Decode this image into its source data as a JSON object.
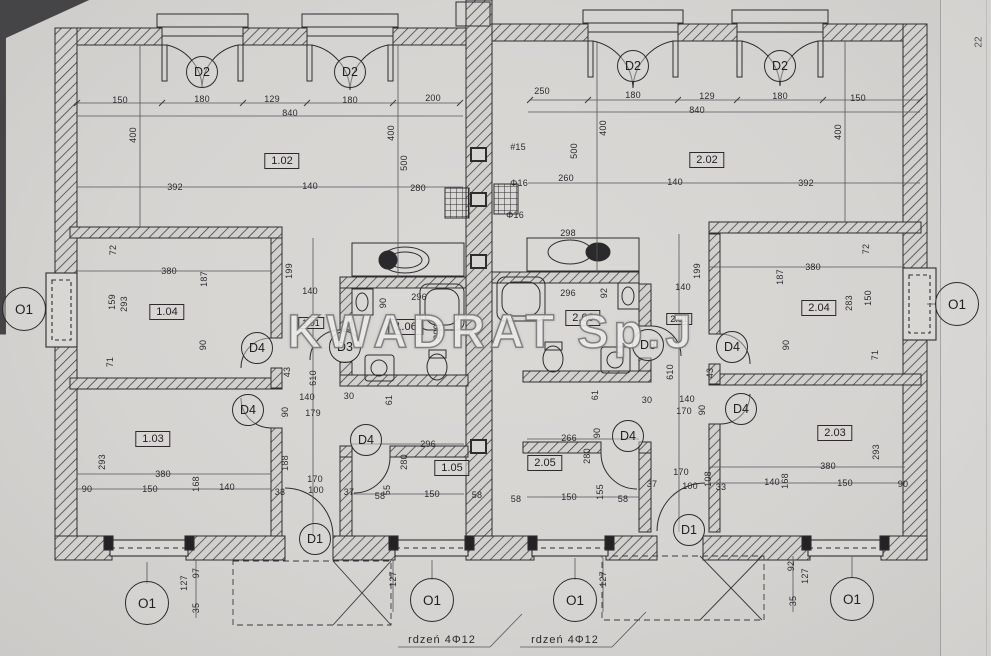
{
  "watermark": "KWADRAT Sp.J",
  "side_note": "22",
  "room_labels": [
    {
      "id": "1.02",
      "x": 282,
      "y": 161
    },
    {
      "id": "2.02",
      "x": 707,
      "y": 160
    },
    {
      "id": "1.04",
      "x": 167,
      "y": 312
    },
    {
      "id": "2.04",
      "x": 819,
      "y": 308
    },
    {
      "id": "1.06",
      "x": 406,
      "y": 327
    },
    {
      "id": "2.06",
      "x": 583,
      "y": 318
    },
    {
      "id": "1.03",
      "x": 153,
      "y": 439
    },
    {
      "id": "2.03",
      "x": 835,
      "y": 433
    },
    {
      "id": "1.05",
      "x": 452,
      "y": 468
    },
    {
      "id": "2.05",
      "x": 545,
      "y": 463
    }
  ],
  "hall_labels": [
    {
      "id": "1.01",
      "x": 311,
      "y": 323
    },
    {
      "id": "2.01",
      "x": 679,
      "y": 319
    }
  ],
  "door_tags": [
    {
      "id": "D2",
      "x": 202,
      "y": 72
    },
    {
      "id": "D2",
      "x": 350,
      "y": 72
    },
    {
      "id": "D2",
      "x": 633,
      "y": 66
    },
    {
      "id": "D2",
      "x": 780,
      "y": 66
    },
    {
      "id": "D4",
      "x": 257,
      "y": 348
    },
    {
      "id": "D4",
      "x": 248,
      "y": 410
    },
    {
      "id": "D4",
      "x": 366,
      "y": 440
    },
    {
      "id": "D4",
      "x": 628,
      "y": 436
    },
    {
      "id": "D4",
      "x": 732,
      "y": 347
    },
    {
      "id": "D4",
      "x": 741,
      "y": 409
    },
    {
      "id": "D3",
      "x": 345,
      "y": 347
    },
    {
      "id": "D3",
      "x": 648,
      "y": 345
    },
    {
      "id": "D1",
      "x": 315,
      "y": 539
    },
    {
      "id": "D1",
      "x": 689,
      "y": 530
    }
  ],
  "window_tags": [
    {
      "id": "O1",
      "x": 24,
      "y": 309
    },
    {
      "id": "O1",
      "x": 957,
      "y": 304
    },
    {
      "id": "O1",
      "x": 147,
      "y": 603
    },
    {
      "id": "O1",
      "x": 432,
      "y": 600
    },
    {
      "id": "O1",
      "x": 575,
      "y": 600
    },
    {
      "id": "O1",
      "x": 852,
      "y": 599
    }
  ],
  "notes": [
    {
      "t": "rdzeń 4Φ12",
      "x": 442,
      "y": 640
    },
    {
      "t": "rdzeń 4Φ12",
      "x": 565,
      "y": 640
    }
  ],
  "dims": [
    {
      "t": "150",
      "x": 120,
      "y": 100
    },
    {
      "t": "180",
      "x": 202,
      "y": 99
    },
    {
      "t": "129",
      "x": 272,
      "y": 99
    },
    {
      "t": "180",
      "x": 350,
      "y": 100
    },
    {
      "t": "200",
      "x": 433,
      "y": 98
    },
    {
      "t": "840",
      "x": 290,
      "y": 113
    },
    {
      "t": "250",
      "x": 542,
      "y": 91
    },
    {
      "t": "180",
      "x": 633,
      "y": 95
    },
    {
      "t": "129",
      "x": 707,
      "y": 96
    },
    {
      "t": "180",
      "x": 780,
      "y": 96
    },
    {
      "t": "150",
      "x": 858,
      "y": 98
    },
    {
      "t": "840",
      "x": 697,
      "y": 110
    },
    {
      "t": "400",
      "x": 133,
      "y": 135,
      "r": 1
    },
    {
      "t": "400",
      "x": 391,
      "y": 133,
      "r": 1
    },
    {
      "t": "500",
      "x": 404,
      "y": 163,
      "r": 1
    },
    {
      "t": "500",
      "x": 574,
      "y": 151,
      "r": 1
    },
    {
      "t": "400",
      "x": 603,
      "y": 128,
      "r": 1
    },
    {
      "t": "400",
      "x": 838,
      "y": 132,
      "r": 1
    },
    {
      "t": "392",
      "x": 175,
      "y": 187
    },
    {
      "t": "140",
      "x": 310,
      "y": 186
    },
    {
      "t": "140",
      "x": 675,
      "y": 182
    },
    {
      "t": "392",
      "x": 806,
      "y": 183
    },
    {
      "t": "280",
      "x": 418,
      "y": 188
    },
    {
      "t": "260",
      "x": 566,
      "y": 178
    },
    {
      "t": "298",
      "x": 568,
      "y": 233
    },
    {
      "t": "#15",
      "x": 518,
      "y": 147
    },
    {
      "t": "Φ16",
      "x": 519,
      "y": 183
    },
    {
      "t": "Φ16",
      "x": 515,
      "y": 215
    },
    {
      "t": "296",
      "x": 419,
      "y": 297
    },
    {
      "t": "296",
      "x": 568,
      "y": 293
    },
    {
      "t": "90",
      "x": 383,
      "y": 303,
      "r": 1
    },
    {
      "t": "92",
      "x": 604,
      "y": 293,
      "r": 1
    },
    {
      "t": "200",
      "x": 437,
      "y": 332,
      "r": 1
    },
    {
      "t": "72",
      "x": 113,
      "y": 250,
      "r": 1
    },
    {
      "t": "380",
      "x": 169,
      "y": 271
    },
    {
      "t": "187",
      "x": 204,
      "y": 279,
      "r": 1
    },
    {
      "t": "159",
      "x": 112,
      "y": 302,
      "r": 1
    },
    {
      "t": "293",
      "x": 124,
      "y": 304,
      "r": 1
    },
    {
      "t": "90",
      "x": 203,
      "y": 345,
      "r": 1
    },
    {
      "t": "71",
      "x": 110,
      "y": 362,
      "r": 1
    },
    {
      "t": "199",
      "x": 289,
      "y": 271,
      "r": 1
    },
    {
      "t": "140",
      "x": 310,
      "y": 291
    },
    {
      "t": "43",
      "x": 287,
      "y": 372,
      "r": 1
    },
    {
      "t": "610",
      "x": 313,
      "y": 378,
      "r": 1
    },
    {
      "t": "140",
      "x": 307,
      "y": 397
    },
    {
      "t": "179",
      "x": 313,
      "y": 413
    },
    {
      "t": "90",
      "x": 285,
      "y": 412,
      "r": 1
    },
    {
      "t": "72",
      "x": 866,
      "y": 249,
      "r": 1
    },
    {
      "t": "380",
      "x": 813,
      "y": 267
    },
    {
      "t": "187",
      "x": 780,
      "y": 277,
      "r": 1
    },
    {
      "t": "283",
      "x": 849,
      "y": 303,
      "r": 1
    },
    {
      "t": "150",
      "x": 868,
      "y": 298,
      "r": 1
    },
    {
      "t": "90",
      "x": 786,
      "y": 345,
      "r": 1
    },
    {
      "t": "71",
      "x": 875,
      "y": 355,
      "r": 1
    },
    {
      "t": "199",
      "x": 697,
      "y": 271,
      "r": 1
    },
    {
      "t": "140",
      "x": 683,
      "y": 287
    },
    {
      "t": "43",
      "x": 710,
      "y": 373,
      "r": 1
    },
    {
      "t": "610",
      "x": 670,
      "y": 372,
      "r": 1
    },
    {
      "t": "140",
      "x": 687,
      "y": 399
    },
    {
      "t": "170",
      "x": 684,
      "y": 411
    },
    {
      "t": "90",
      "x": 702,
      "y": 410,
      "r": 1
    },
    {
      "t": "30",
      "x": 647,
      "y": 400
    },
    {
      "t": "61",
      "x": 595,
      "y": 395,
      "r": 1
    },
    {
      "t": "30",
      "x": 349,
      "y": 396
    },
    {
      "t": "61",
      "x": 389,
      "y": 400,
      "r": 1
    },
    {
      "t": "293",
      "x": 102,
      "y": 462,
      "r": 1
    },
    {
      "t": "380",
      "x": 163,
      "y": 474
    },
    {
      "t": "90",
      "x": 87,
      "y": 489
    },
    {
      "t": "150",
      "x": 150,
      "y": 489
    },
    {
      "t": "168",
      "x": 196,
      "y": 484,
      "r": 1
    },
    {
      "t": "140",
      "x": 227,
      "y": 487
    },
    {
      "t": "188",
      "x": 285,
      "y": 463,
      "r": 1
    },
    {
      "t": "33",
      "x": 280,
      "y": 492
    },
    {
      "t": "100",
      "x": 316,
      "y": 490
    },
    {
      "t": "170",
      "x": 315,
      "y": 479
    },
    {
      "t": "293",
      "x": 876,
      "y": 452,
      "r": 1
    },
    {
      "t": "380",
      "x": 828,
      "y": 466
    },
    {
      "t": "140",
      "x": 772,
      "y": 482
    },
    {
      "t": "150",
      "x": 845,
      "y": 483
    },
    {
      "t": "90",
      "x": 903,
      "y": 484
    },
    {
      "t": "168",
      "x": 785,
      "y": 481,
      "r": 1
    },
    {
      "t": "108",
      "x": 708,
      "y": 479,
      "r": 1
    },
    {
      "t": "33",
      "x": 721,
      "y": 487
    },
    {
      "t": "100",
      "x": 690,
      "y": 486
    },
    {
      "t": "170",
      "x": 681,
      "y": 472
    },
    {
      "t": "296",
      "x": 428,
      "y": 444
    },
    {
      "t": "280",
      "x": 404,
      "y": 462,
      "r": 1
    },
    {
      "t": "58",
      "x": 380,
      "y": 496
    },
    {
      "t": "150",
      "x": 432,
      "y": 494
    },
    {
      "t": "58",
      "x": 477,
      "y": 495
    },
    {
      "t": "37",
      "x": 349,
      "y": 492
    },
    {
      "t": "55",
      "x": 387,
      "y": 490,
      "r": 1
    },
    {
      "t": "266",
      "x": 569,
      "y": 438
    },
    {
      "t": "280",
      "x": 587,
      "y": 456,
      "r": 1
    },
    {
      "t": "90",
      "x": 597,
      "y": 433,
      "r": 1
    },
    {
      "t": "58",
      "x": 516,
      "y": 499
    },
    {
      "t": "150",
      "x": 569,
      "y": 497
    },
    {
      "t": "155",
      "x": 600,
      "y": 492,
      "r": 1
    },
    {
      "t": "58",
      "x": 623,
      "y": 499
    },
    {
      "t": "37",
      "x": 652,
      "y": 484
    },
    {
      "t": "127",
      "x": 184,
      "y": 583,
      "r": 1
    },
    {
      "t": "97",
      "x": 196,
      "y": 573,
      "r": 1
    },
    {
      "t": "35",
      "x": 196,
      "y": 608,
      "r": 1
    },
    {
      "t": "127",
      "x": 393,
      "y": 579,
      "r": 1
    },
    {
      "t": "127",
      "x": 603,
      "y": 579,
      "r": 1
    },
    {
      "t": "92",
      "x": 791,
      "y": 566,
      "r": 1
    },
    {
      "t": "127",
      "x": 805,
      "y": 576,
      "r": 1
    },
    {
      "t": "35",
      "x": 793,
      "y": 601,
      "r": 1
    }
  ]
}
